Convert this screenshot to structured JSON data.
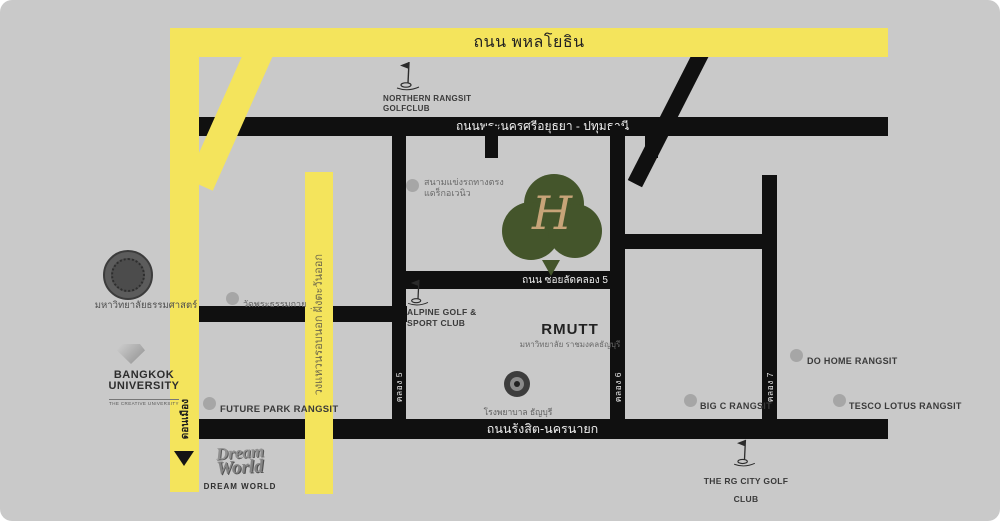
{
  "colors": {
    "background": "#c9c9c9",
    "road_black": "#101010",
    "road_yellow": "#f4e45c",
    "logo_green": "#44552b",
    "logo_monogram_gold": "#c7a478",
    "marker_gray": "#a6a6a6"
  },
  "roads": {
    "phahonyothin": {
      "label": "ถนน พหลโยธิน"
    },
    "ayutthaya_pathumthani": {
      "label": "ถนนพระนครศรีอยุธยา - ปทุมธานี"
    },
    "soi_lat_khlong_5": {
      "label": "ถนน ซอยลัดคลอง 5"
    },
    "rangsit_nakhon_nayok": {
      "label": "ถนนรังสิต-นครนายก"
    },
    "outer_ring_east": {
      "label": "วงแหวนรอบนอก ฝั่งตะวันออก"
    },
    "don_mueang": {
      "label": "ดอนเมือง"
    },
    "khlong_5": {
      "label": "คลอง 5"
    },
    "khlong_6": {
      "label": "คลอง 6"
    },
    "khlong_7": {
      "label": "คลอง 7"
    }
  },
  "pois": {
    "northern_rangsit_golf": {
      "line1": "NORTHERN RANGSIT",
      "line2": "GOLFCLUB"
    },
    "thammasat": {
      "label": "มหาวิทยาลัยธรรมศาสตร์"
    },
    "bangkok_university": {
      "line1": "BANGKOK",
      "line2": "UNIVERSITY",
      "line3": "THE CREATIVE UNIVERSITY"
    },
    "wat_phra_dhammakaya": {
      "label": "วัดพระธรรมกาย"
    },
    "drag_avenue": {
      "line1": "สนามแข่งรถทางตรง",
      "line2": "แดร็กอเวนิว"
    },
    "future_park": {
      "label": "FUTURE PARK RANGSIT"
    },
    "dream_world": {
      "logo_line1": "Dream",
      "logo_line2": "World",
      "caption": "DREAM WORLD"
    },
    "alpine_golf": {
      "line1": "ALPINE GOLF &",
      "line2": "SPORT CLUB"
    },
    "rmutt": {
      "name": "RMUTT",
      "thai": "มหาวิทยาลัย ราชมงคลธัญบุรี"
    },
    "thanyaburi_hospital": {
      "label": "โรงพยาบาล ธัญบุรี"
    },
    "big_c": {
      "label": "BIG C RANGSIT"
    },
    "do_home": {
      "label": "DO HOME RANGSIT"
    },
    "tesco_lotus": {
      "label": "TESCO LOTUS RANGSIT"
    },
    "rg_city_golf": {
      "label": "THE RG CITY GOLF CLUB"
    },
    "h_monogram": {
      "letter": "H"
    }
  }
}
